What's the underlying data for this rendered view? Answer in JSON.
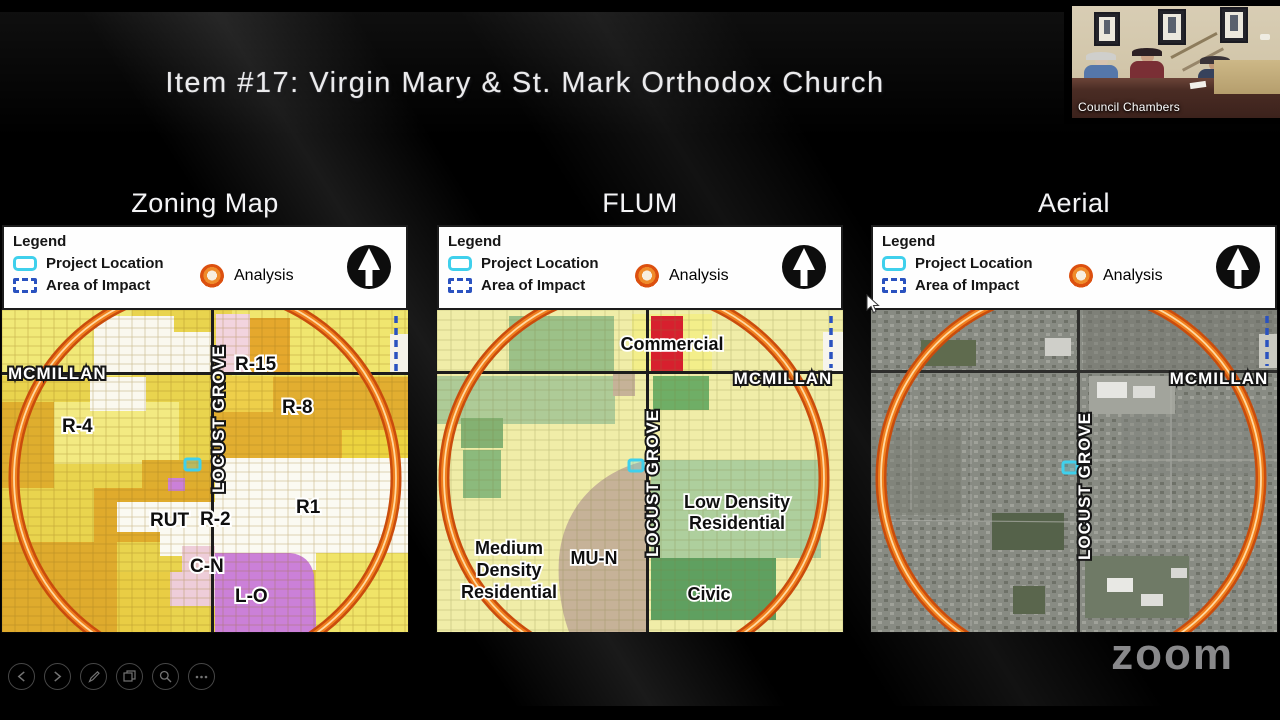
{
  "header": {
    "title": "Item #17: Virgin Mary & St. Mark Orthodox Church"
  },
  "webcam": {
    "label": "Council Chambers"
  },
  "watermark": {
    "label": "zoom"
  },
  "legend": {
    "title": "Legend",
    "project_location": "Project Location",
    "area_of_impact": "Area of Impact",
    "analysis": "Analysis"
  },
  "panels": {
    "zoning": {
      "title": "Zoning Map",
      "labels": {
        "mcmillan": "MCMILLAN",
        "locust_grove": "LOCUST GROVE",
        "r15": "R-15",
        "r8": "R-8",
        "r4": "R-4",
        "rut": "RUT",
        "r2": "R-2",
        "r1": "R1",
        "cn": "C-N",
        "lo": "L-O"
      }
    },
    "flum": {
      "title": "FLUM",
      "labels": {
        "commercial": "Commercial",
        "mcmillan": "MCMILLAN",
        "locust_grove": "LOCUST GROVE",
        "low_density_1": "Low Density",
        "low_density_2": "Residential",
        "medium_density_1": "Medium",
        "medium_density_2": "Density",
        "medium_density_3": "Residential",
        "mun": "MU-N",
        "civic": "Civic"
      }
    },
    "aerial": {
      "title": "Aerial",
      "labels": {
        "mcmillan": "MCMILLAN",
        "locust_grove": "LOCUST GROVE"
      }
    }
  },
  "controls": {
    "icons": [
      "previous-slide",
      "next-slide",
      "pen",
      "see-all-slides",
      "zoom-to-slide",
      "more-options"
    ]
  },
  "colors": {
    "analysis_ring": "#dc500f",
    "project_location": "#3fd0ec",
    "area_of_impact": "#2a52c0",
    "zoning_yellow": "#e9d44e",
    "flum_yellow": "#f0eda8",
    "lo_purple": "#cb80d8",
    "commercial_red": "#d7202e",
    "civic_green": "#5fa060"
  }
}
